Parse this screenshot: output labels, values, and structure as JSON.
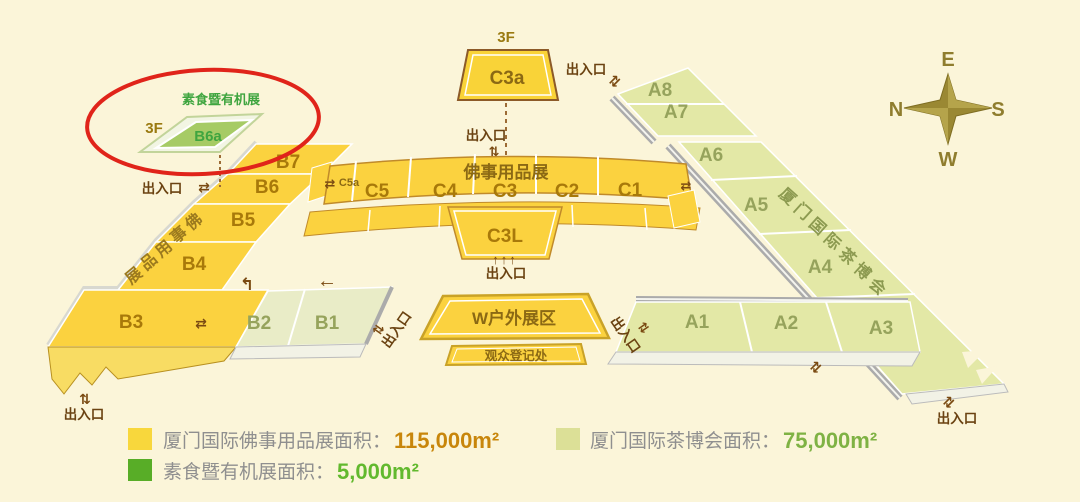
{
  "canvas": {
    "background": "#FBF5D9"
  },
  "colors": {
    "buddhist_yellow": "#FBD23F",
    "tea_green": "#E3E8A6",
    "annex_sage": "#E9ECC7",
    "organic_green": "#A6CB65",
    "highlight_red": "#E0241A",
    "legend_yellow": "#F8D73C",
    "legend_tea": "#DCE097",
    "legend_organic": "#58AD27",
    "value_orange": "#C8860B",
    "value_green_tea": "#7FB244",
    "value_green_organic": "#62B92E"
  },
  "highlight": {
    "expo_label": "素食暨有机展",
    "floor_label": "3F",
    "hall": "B6a"
  },
  "c3a": {
    "floor": "3F",
    "label": "C3a"
  },
  "c_complex": {
    "header": "佛事用品展",
    "row": [
      "C5",
      "C4",
      "C3",
      "C2",
      "C1"
    ],
    "lower": "C3L",
    "c5a": "C5a"
  },
  "b_strip": {
    "label": "佛事用品展",
    "halls": [
      "B7",
      "B6",
      "B5",
      "B4",
      "B3"
    ]
  },
  "b_annex": {
    "halls": [
      "B2",
      "B1"
    ]
  },
  "a_strip": {
    "label": "厦门国际茶博会",
    "halls": [
      "A8",
      "A7",
      "A6",
      "A5",
      "A4"
    ]
  },
  "a_row": {
    "halls": [
      "A1",
      "A2",
      "A3"
    ]
  },
  "outdoor": {
    "w_zone": "W户外展区",
    "registration": "观众登记处"
  },
  "labels": {
    "entrance": "出入口"
  },
  "icons": {
    "updown_arrows": "⇅",
    "exchange_arrows": "⇄",
    "left_arrow": "←",
    "turn_arrow": "↰",
    "triple_up": "↑↑↑"
  },
  "compass": {
    "top": "E",
    "left": "N",
    "right": "S",
    "bottom": "W"
  },
  "legend": {
    "items": [
      {
        "label": "厦门国际佛事用品展面积：",
        "value": "115,000m²"
      },
      {
        "label": "厦门国际茶博会面积：",
        "value": "75,000m²"
      },
      {
        "label": "素食暨有机展面积：",
        "value": "5,000m²"
      }
    ]
  }
}
